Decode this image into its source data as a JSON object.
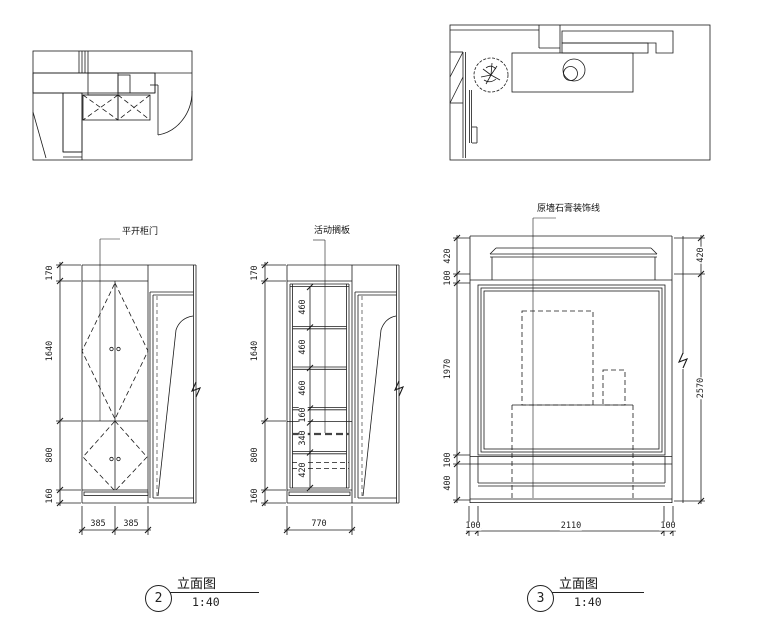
{
  "page": {
    "background": "#ffffff",
    "line_color": "#1a1a1a",
    "fill_gray": "#c9c9c9"
  },
  "elevation2": {
    "caption": {
      "number": "2",
      "title": "立面图",
      "scale": "1:40"
    },
    "left_view": {
      "label": "平开柜门",
      "dims_left": [
        "170",
        "1640",
        "800",
        "160"
      ],
      "dims_bottom": [
        "385",
        "385"
      ]
    },
    "middle_view": {
      "label": "活动搁板",
      "dims_left": [
        "170",
        "1640",
        "800",
        "160"
      ],
      "dims_inner": [
        "460",
        "460",
        "460",
        "160",
        "340",
        "420"
      ],
      "dims_bottom": [
        "770"
      ]
    }
  },
  "elevation3": {
    "caption": {
      "number": "3",
      "title": "立面图",
      "scale": "1:40"
    },
    "label": "原墙石膏装饰线",
    "dims_left": [
      "420",
      "100",
      "1970",
      "100",
      "400"
    ],
    "dims_right": [
      "420",
      "2570"
    ],
    "dims_bottom": [
      "100",
      "2110",
      "100"
    ]
  }
}
